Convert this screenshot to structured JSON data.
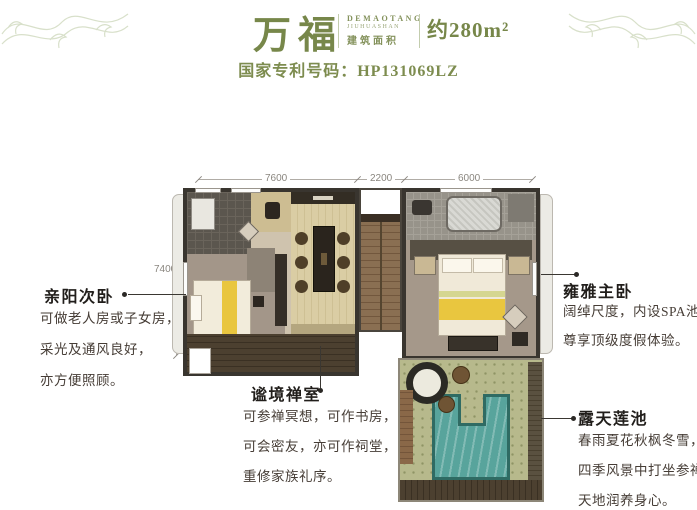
{
  "colors": {
    "accent_olive": "#77874a",
    "annotation_text": "#463d36",
    "pool_teal": "#58a49c",
    "wall_dark": "#39352f"
  },
  "header": {
    "title": "万福",
    "brand_line1": "DEMAOTANG",
    "brand_line2": "JIUHUASHAN",
    "area_label": "建筑面积",
    "area_value": "约280m²",
    "patent": "国家专利号码：HP131069LZ"
  },
  "plan": {
    "dims": {
      "top": [
        "7600",
        "2200",
        "6000"
      ],
      "left": "7400"
    }
  },
  "annotations": [
    {
      "title": "亲阳次卧",
      "lines": [
        "可做老人房或子女房，",
        "采光及通风良好，",
        "亦方便照顾。"
      ]
    },
    {
      "title": "雍雅主卧",
      "lines": [
        "阔绰尺度，内设SPA池，",
        "尊享顶级度假体验。"
      ]
    },
    {
      "title": "谧境禅室",
      "lines": [
        "可参禅冥想，可作书房，",
        "可会密友，亦可作祠堂，",
        "重修家族礼序。"
      ]
    },
    {
      "title": "露天莲池",
      "lines": [
        "春雨夏花秋枫冬雪，",
        "四季风景中打坐参禅，",
        "天地润养身心。"
      ]
    }
  ]
}
